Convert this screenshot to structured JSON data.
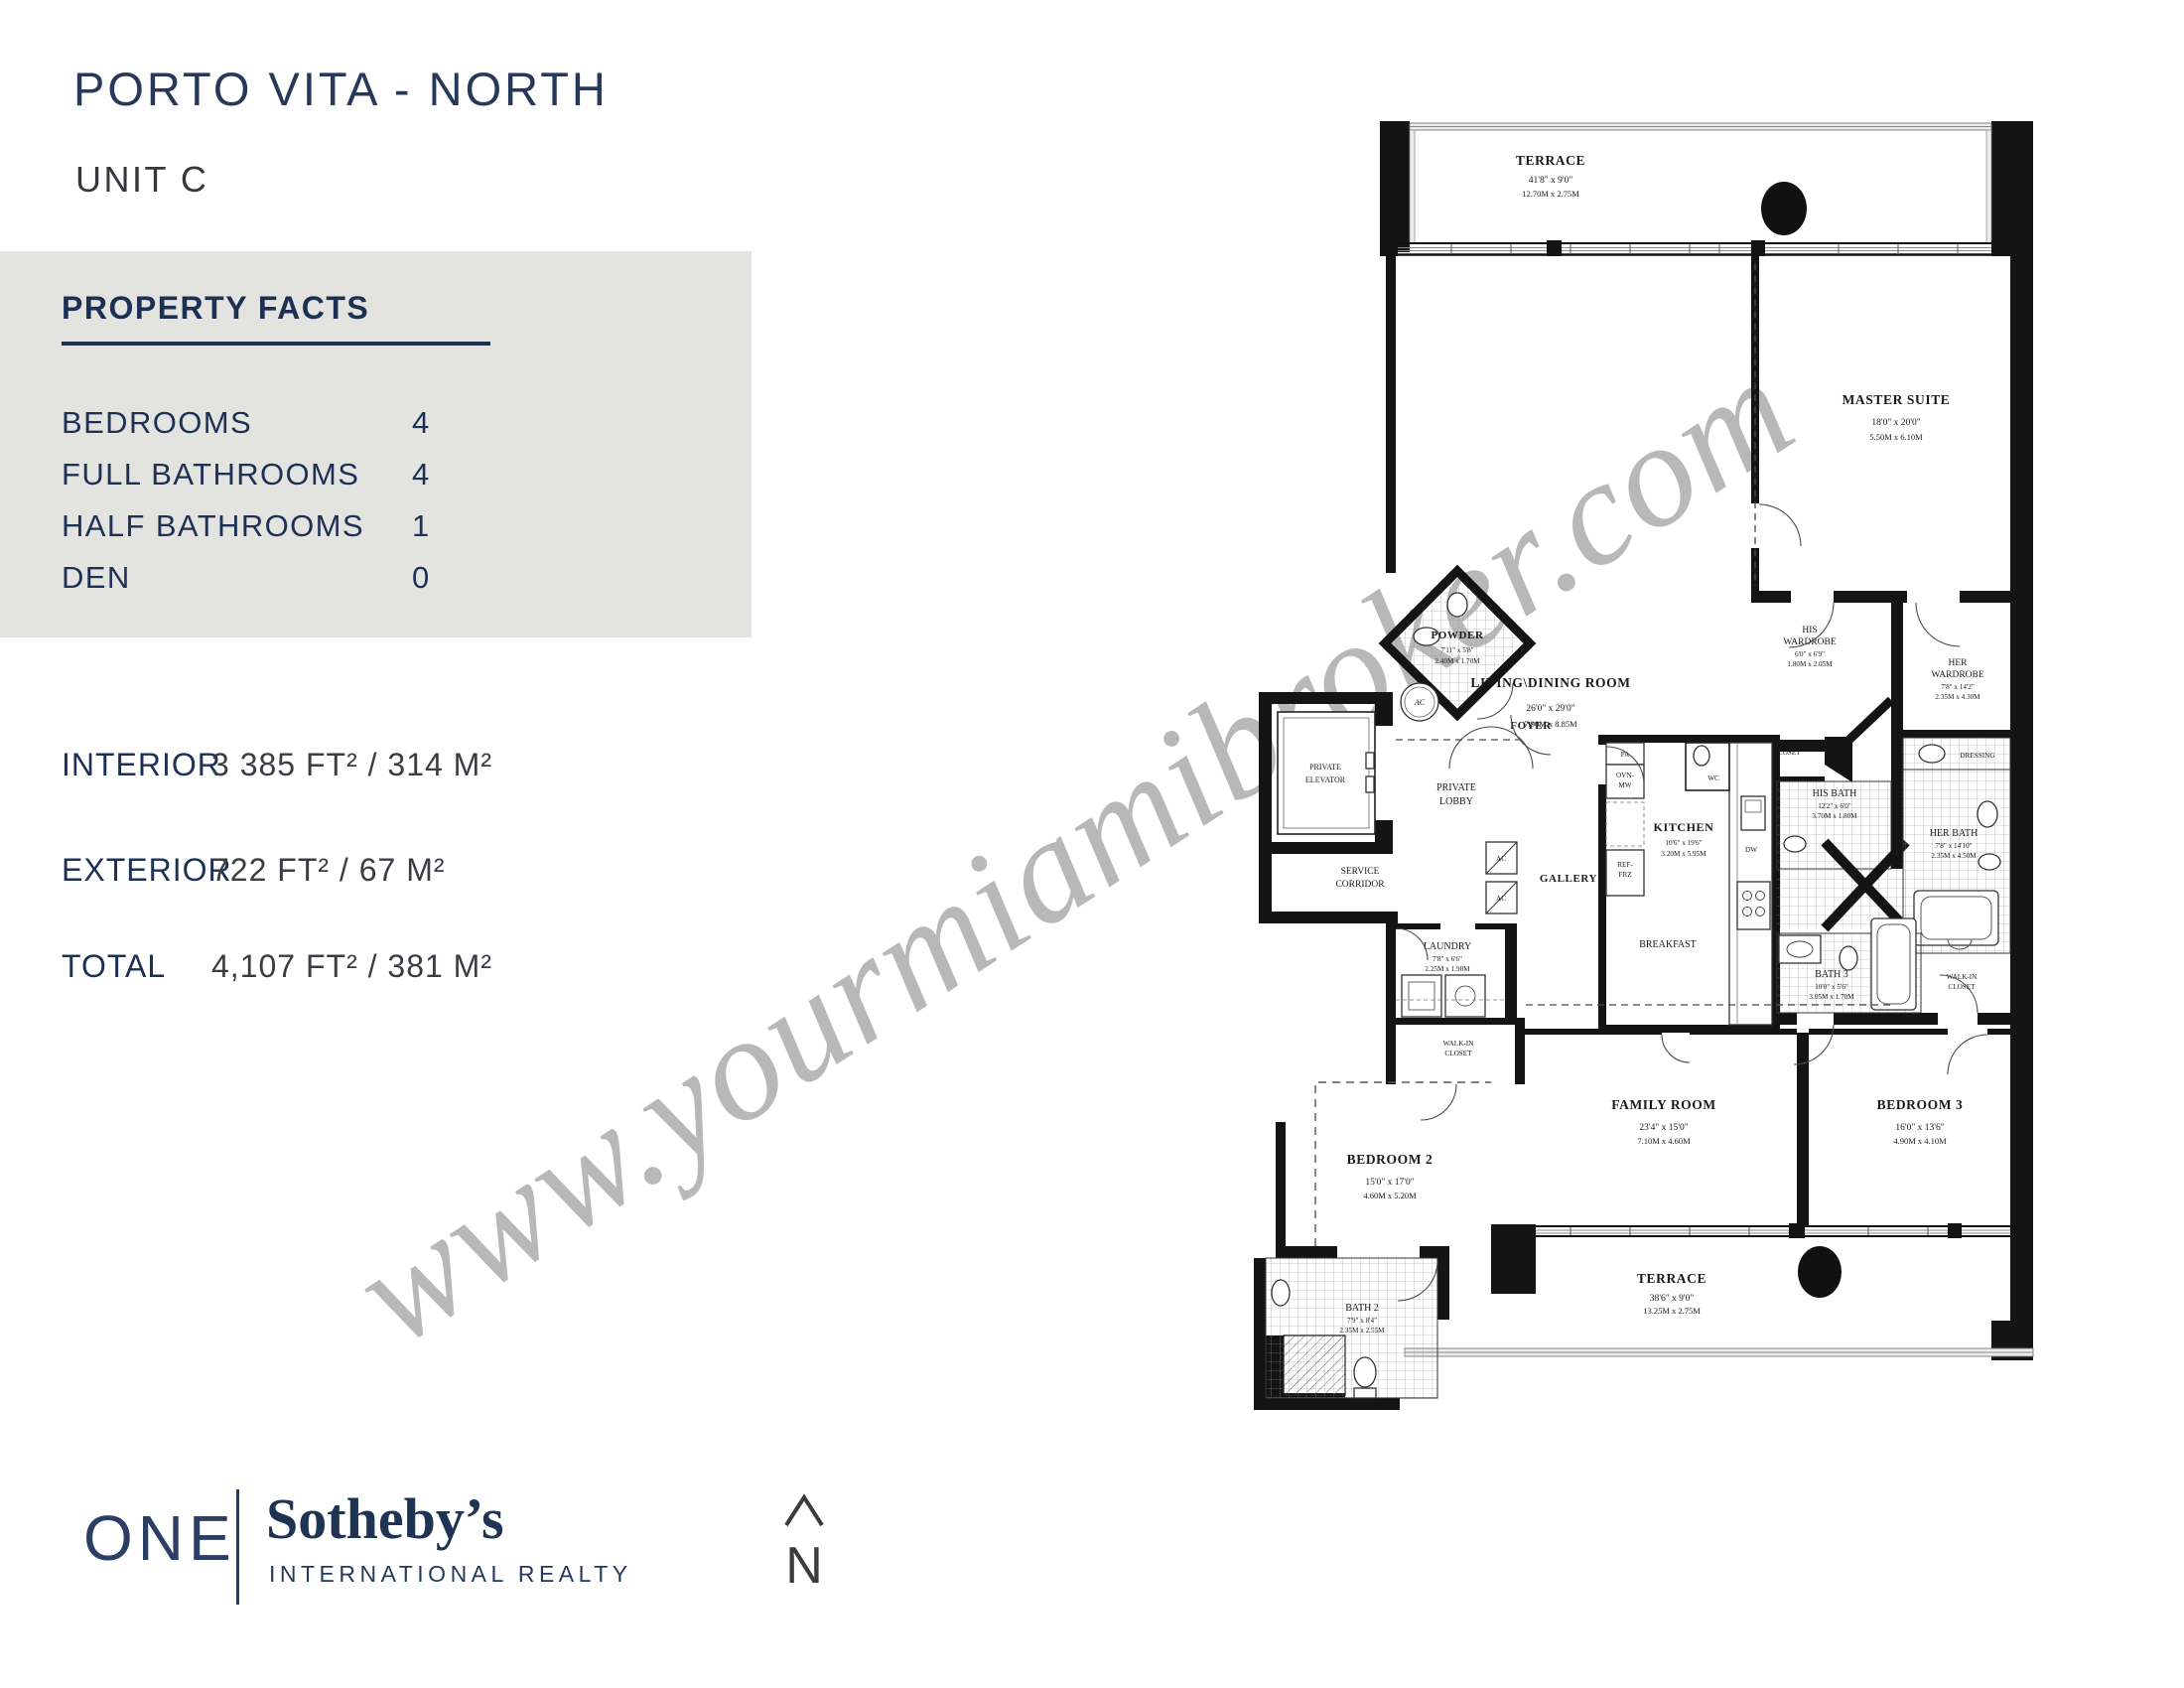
{
  "page": {
    "title": "PORTO VITA - NORTH",
    "subtitle": "UNIT C"
  },
  "property_facts": {
    "heading": "PROPERTY FACTS",
    "rows": [
      {
        "label": "BEDROOMS",
        "value": "4"
      },
      {
        "label": "FULL BATHROOMS",
        "value": "4"
      },
      {
        "label": "HALF BATHROOMS",
        "value": "1"
      },
      {
        "label": "DEN",
        "value": "0"
      }
    ]
  },
  "areas": {
    "rows": [
      {
        "label": "INTERIOR",
        "value": "3 385 FT²  /  314 M²"
      },
      {
        "label": "EXTERIOR",
        "value": "722 FT²  /  67 M²"
      },
      {
        "label": "TOTAL",
        "value": "4,107 FT²  /  381 M²"
      }
    ]
  },
  "brand": {
    "one": "ONE",
    "sothebys": "Sotheby’s",
    "tagline": "INTERNATIONAL REALTY"
  },
  "compass": {
    "letter": "N"
  },
  "watermark": "www.yourmiamibroker.com",
  "colors": {
    "navy": "#1d3156",
    "box_gray": "#e3e3df",
    "watermark_gray": "#7d7d7d",
    "plan_black": "#141414"
  },
  "floorplan": {
    "terrace_top": {
      "name": "TERRACE",
      "ft": "41'8\" x 9'0\"",
      "m": "12.70M x 2.75M"
    },
    "living": {
      "name": "LIVING\\DINING ROOM",
      "ft": "26'0\" x 29'0\"",
      "m": "7.90M x 8.85M"
    },
    "master": {
      "name": "MASTER SUITE",
      "ft": "18'0\" x 20'0\"",
      "m": "5.50M x 6.10M"
    },
    "his_wardrobe": {
      "l1": "HIS",
      "l2": "WARDROBE",
      "ft": "6'0\" x 6'9\"",
      "m": "1.80M x 2.05M"
    },
    "her_wardrobe": {
      "l1": "HER",
      "l2": "WARDROBE",
      "ft": "7'8\" x 14'2\"",
      "m": "2.35M x 4.30M"
    },
    "powder": {
      "name": "POWDER",
      "ft": "7'11\" x 5'8\"",
      "m": "2.40M x 1.70M"
    },
    "foyer": {
      "name": "FOYER"
    },
    "private_elevator": {
      "l1": "PRIVATE",
      "l2": "ELEVATOR"
    },
    "private_lobby": {
      "l1": "PRIVATE",
      "l2": "LOBBY"
    },
    "service_corridor": {
      "l1": "SERVICE",
      "l2": "CORRIDOR"
    },
    "gallery": {
      "name": "GALLERY"
    },
    "laundry": {
      "name": "LAUNDRY",
      "ft": "7'8\" x 6'6\"",
      "m": "2.25M x 1.98M"
    },
    "kitchen": {
      "name": "KITCHEN",
      "ft": "10'6\" x 19'6\"",
      "m": "3.20M x 5.95M"
    },
    "breakfast": {
      "name": "BREAKFAST"
    },
    "wc": {
      "name": "WC"
    },
    "closet": {
      "name": "CLOSET"
    },
    "his_bath": {
      "name": "HIS BATH",
      "ft": "12'2\" x 6'0\"",
      "m": "3.70M x 1.80M"
    },
    "her_bath": {
      "name": "HER BATH",
      "ft": "7'8\" x 14'10\"",
      "m": "2.35M x 4.50M"
    },
    "dressing": {
      "name": "DRESSING"
    },
    "bath3": {
      "name": "BATH 3",
      "ft": "10'0\" x 5'6\"",
      "m": "3.05M x 1.70M"
    },
    "wic_right": {
      "l1": "WALK-IN",
      "l2": "CLOSET"
    },
    "wic_left": {
      "l1": "WALK-IN",
      "l2": "CLOSET"
    },
    "family": {
      "name": "FAMILY ROOM",
      "ft": "23'4\" x 15'0\"",
      "m": "7.10M x 4.60M"
    },
    "bedroom3": {
      "name": "BEDROOM 3",
      "ft": "16'0\" x 13'6\"",
      "m": "4.90M x 4.10M"
    },
    "bedroom2": {
      "name": "BEDROOM 2",
      "ft": "15'0\" x 17'0\"",
      "m": "4.60M x 5.20M"
    },
    "bath2": {
      "name": "BATH 2",
      "ft": "7'9\" x 8'4\"",
      "m": "2.35M x 2.55M"
    },
    "terrace_bottom": {
      "name": "TERRACE",
      "ft": "38'6\" x 9'0\"",
      "m": "13.25M x 2.75M"
    },
    "appliances": {
      "pa": "PA",
      "ovn": "OVN-",
      "mw": "MW",
      "ref": "REF-",
      "frz": "FRZ",
      "dw": "DW",
      "ac": "AC"
    }
  }
}
